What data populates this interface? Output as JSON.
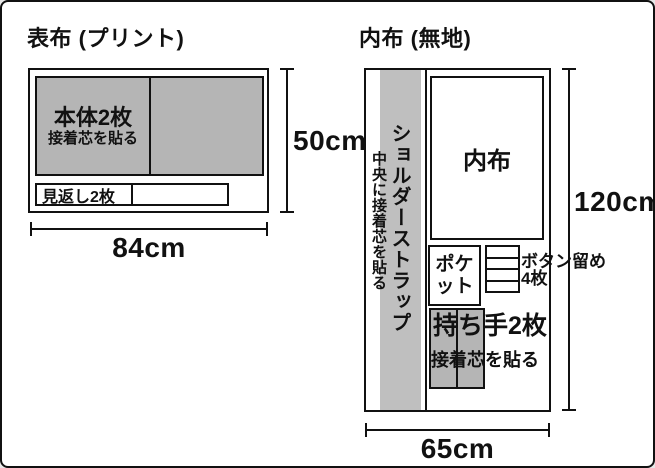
{
  "left_panel": {
    "title": "表布 (プリント)",
    "body_piece": {
      "label": "本体2枚",
      "note": "接着芯を貼る"
    },
    "facing_piece": {
      "label": "見返し2枚"
    },
    "width_label": "84cm",
    "height_label": "50cm"
  },
  "right_panel": {
    "title": "内布 (無地)",
    "strap_piece": {
      "label": "ショルダーストラップ",
      "note": "中央に接着芯を貼る"
    },
    "lining_piece": {
      "label": "内布"
    },
    "pocket_piece": {
      "label": "ポケット"
    },
    "button_pieces": {
      "label": "ボタン留め",
      "count_label": "4枚",
      "count": 4
    },
    "handle_piece": {
      "label": "持ち手2枚",
      "note": "接着芯を貼る"
    },
    "width_label": "65cm",
    "height_label": "120cm"
  },
  "colors": {
    "interfacing_fill": "#b5b5b5",
    "strap_fill": "#bfbfbf",
    "line": "#111111",
    "background": "#ffffff"
  }
}
